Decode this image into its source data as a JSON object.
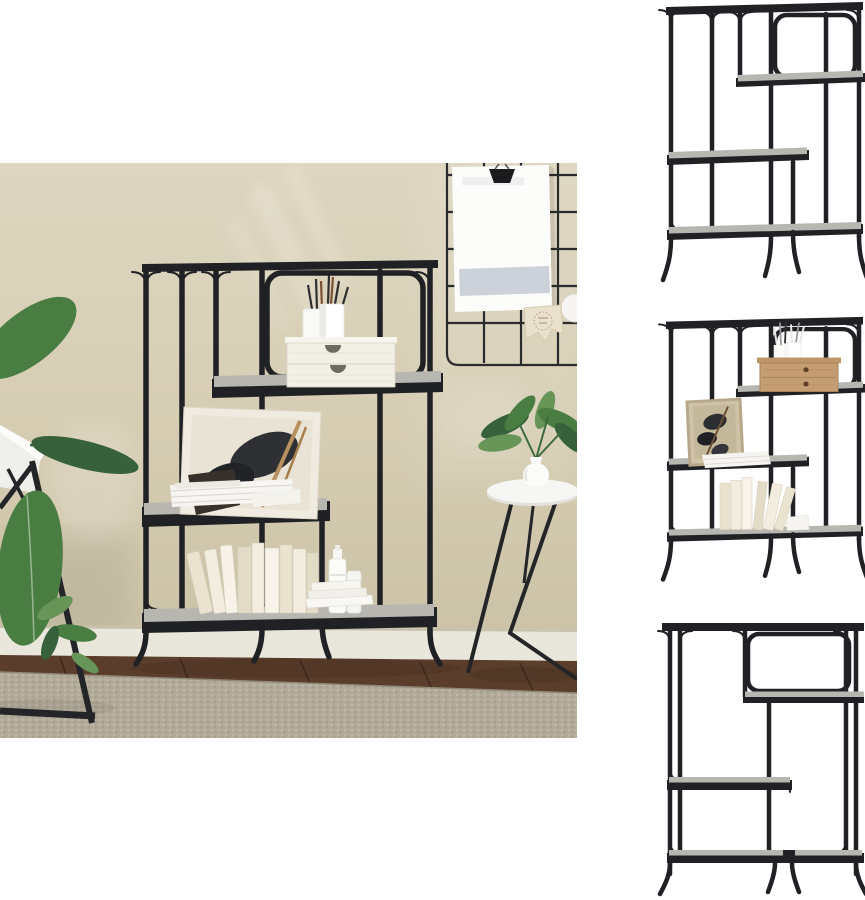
{
  "page": {
    "background": "#ffffff"
  },
  "gallery": {
    "main_image": {
      "label": "Black industrial bookshelf with grey sonoma shelves styled in a beige room with desk, plant, wall grid board and round side table"
    },
    "thumbnails": [
      {
        "label": "Bookshelf angled view on white background, empty"
      },
      {
        "label": "Bookshelf angled view with wooden drawer box, brushes, picture frame and books"
      },
      {
        "label": "Bookshelf front view on white background, empty"
      }
    ]
  },
  "colors": {
    "white": "#ffffff",
    "metal": "#202124",
    "shelf_grey": "#b8b6b0",
    "shelf_grey_light": "#c6c4be",
    "wall_top": "#ddd6c0",
    "wall_mid": "#d6cdb3",
    "wall_bottom": "#cbc2a7",
    "baseboard": "#e9e6db",
    "floor": "#5a3d2a",
    "floor_line": "#3f2a1c",
    "rug": "#b3ab9a",
    "rug_speckle_light": "#c9c2b2",
    "rug_speckle_dark": "#978e7c",
    "grid": "#2a2b2d",
    "paper": "#fcfcfb",
    "paper_band": "#c8ccd5",
    "pennant": "#e9e1cd",
    "clip": "#1b1b1d",
    "desk": "#fbfbf9",
    "desk_front": "#efefec",
    "plant": "#4a7d42",
    "plant_dark": "#36613a",
    "plant_light": "#679457",
    "table_top": "#f6f6f4",
    "vase": "#fbfbf9",
    "drawer_box": "#f2efe7",
    "handle": "#6e6a60",
    "wood_box": "#c49e72",
    "wood_box_dark": "#5d3f24",
    "frame_tan": "#cfc2a6",
    "art_dark": "#2b2d30",
    "book_cream": "#f2edde",
    "book_cream2": "#eae3d0",
    "book_cream3": "#f7f3e8",
    "book_cream4": "#e2dbc6",
    "sign": "#38302a",
    "bottle": "#fbfbf8"
  }
}
